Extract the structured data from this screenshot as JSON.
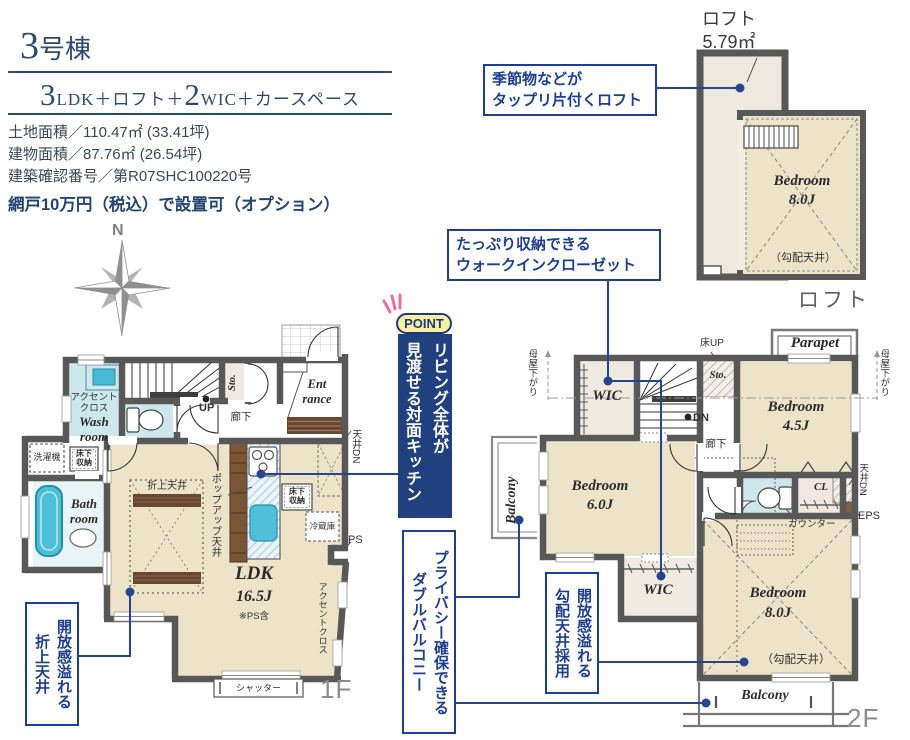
{
  "colors": {
    "accent_navy": "#1d3f8f",
    "wall_gray": "#585858",
    "floor_cream": "#ece3c8",
    "wet_cyan": "#cfe7ea",
    "point_yellow": "#f8f0a0",
    "tub_cyan": "#4cc0d8",
    "wood_brown": "#6a4733"
  },
  "header": {
    "building_num": "3",
    "building_suffix": "号棟",
    "plan": {
      "n1": "3",
      "mid": "LDK＋ロフト＋",
      "n2": "2",
      "tail": "WIC＋カースペース"
    },
    "specs": "土地面積／110.47㎡ (33.41坪)\n建物面積／87.76㎡ (26.54坪)\n建築確認番号／第R07SHC100220号",
    "option": "網戸10万円（税込）で設置可（オプション）"
  },
  "compass": {
    "north": "N"
  },
  "point": {
    "badge": "POINT",
    "banner": "リビング全体が\n見渡せる対面キッチン"
  },
  "callouts": {
    "loft": "季節物などが\nタップリ片付くロフト",
    "wic": "たっぷり収納できる\nウォークインクローゼット",
    "oriage": "開放感溢れる\n折上天井",
    "double_balcony": "プライバシー確保できる\nダブルバルコニー",
    "koubai": "開放感溢れる\n勾配天井採用"
  },
  "loft": {
    "head": "ロフト\n5.79㎡",
    "bedroom": "Bedroom\n8.0J",
    "slope": "（勾配天井）",
    "floor_label": "ロフト"
  },
  "f1": {
    "floor_label": "1F",
    "accent_wash": "アクセント\nクロス",
    "washroom": "Wash\nroom",
    "laundry": "洗濯機",
    "underfloor_a": "床下\n収納",
    "bathroom": "Bath\nroom",
    "up": "UP",
    "hall": "廊下",
    "sto": "Sto.",
    "entrance": "Ent\nrance",
    "ceiling_dn": "天井DN",
    "popup": "ポップアップ天井",
    "underfloor_b": "床下\n収納",
    "fridge": "冷蔵庫",
    "ps": "PS",
    "oriage": "折上天井",
    "ldk": "LDK",
    "ldk_size": "16.5J",
    "ps_note": "※PS含",
    "accent_ldk": "アクセントクロス",
    "shutter": "シャッター"
  },
  "f2": {
    "floor_label": "2F",
    "moya_left": "母屋下がり",
    "moya_right": "母屋下がり",
    "wic_top": "WIC",
    "yuka_up": "床UP",
    "sto": "Sto.",
    "dn": "DN",
    "parapet": "Parapet",
    "bed45": "Bedroom\n4.5J",
    "hall": "廊下",
    "balcony_left": "Balcony",
    "bed6": "Bedroom\n6.0J",
    "wic_bottom": "WIC",
    "counter": "カウンター",
    "cl": "CL",
    "ceiling_dn": "天井DN",
    "eps": "EPS",
    "bed8": "Bedroom\n8.0J",
    "slope": "（勾配天井）",
    "balcony_bottom": "Balcony"
  }
}
